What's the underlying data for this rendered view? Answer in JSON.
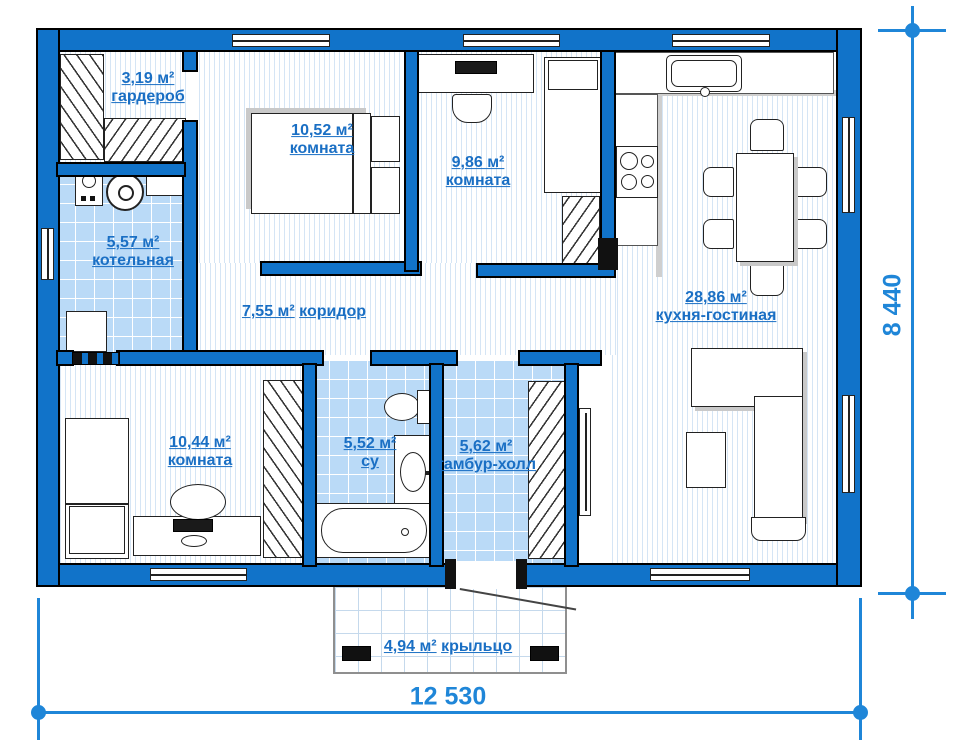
{
  "plan_title": "one-storey house floor plan",
  "colors": {
    "wall": "#1173c9",
    "label_text": "#1a6fc4",
    "dimension": "#1f86d8",
    "tile_floor": "#badaf7",
    "stripe_floor": "#d5e5f5"
  },
  "rooms": {
    "wardrobe": {
      "area": "3,19 м²",
      "name": "гардероб"
    },
    "boiler": {
      "area": "5,57 м²",
      "name": "котельная"
    },
    "bedroom_1": {
      "area": "10,52 м²",
      "name": "комната"
    },
    "bedroom_2": {
      "area": "9,86 м²",
      "name": "комната"
    },
    "kitchen_living": {
      "area": "28,86 м²",
      "name": "кухня-гостиная"
    },
    "corridor": {
      "area": "7,55 м²",
      "name": "коридор"
    },
    "bedroom_3": {
      "area": "10,44 м²",
      "name": "комната"
    },
    "bathroom": {
      "area": "5,52 м²",
      "name": "су"
    },
    "hall": {
      "area": "5,62 м²",
      "name": "тамбур-холл"
    },
    "porch": {
      "area": "4,94 м²",
      "name": "крыльцо"
    }
  },
  "dimensions": {
    "width_label": "12 530",
    "height_label": "8 440"
  }
}
